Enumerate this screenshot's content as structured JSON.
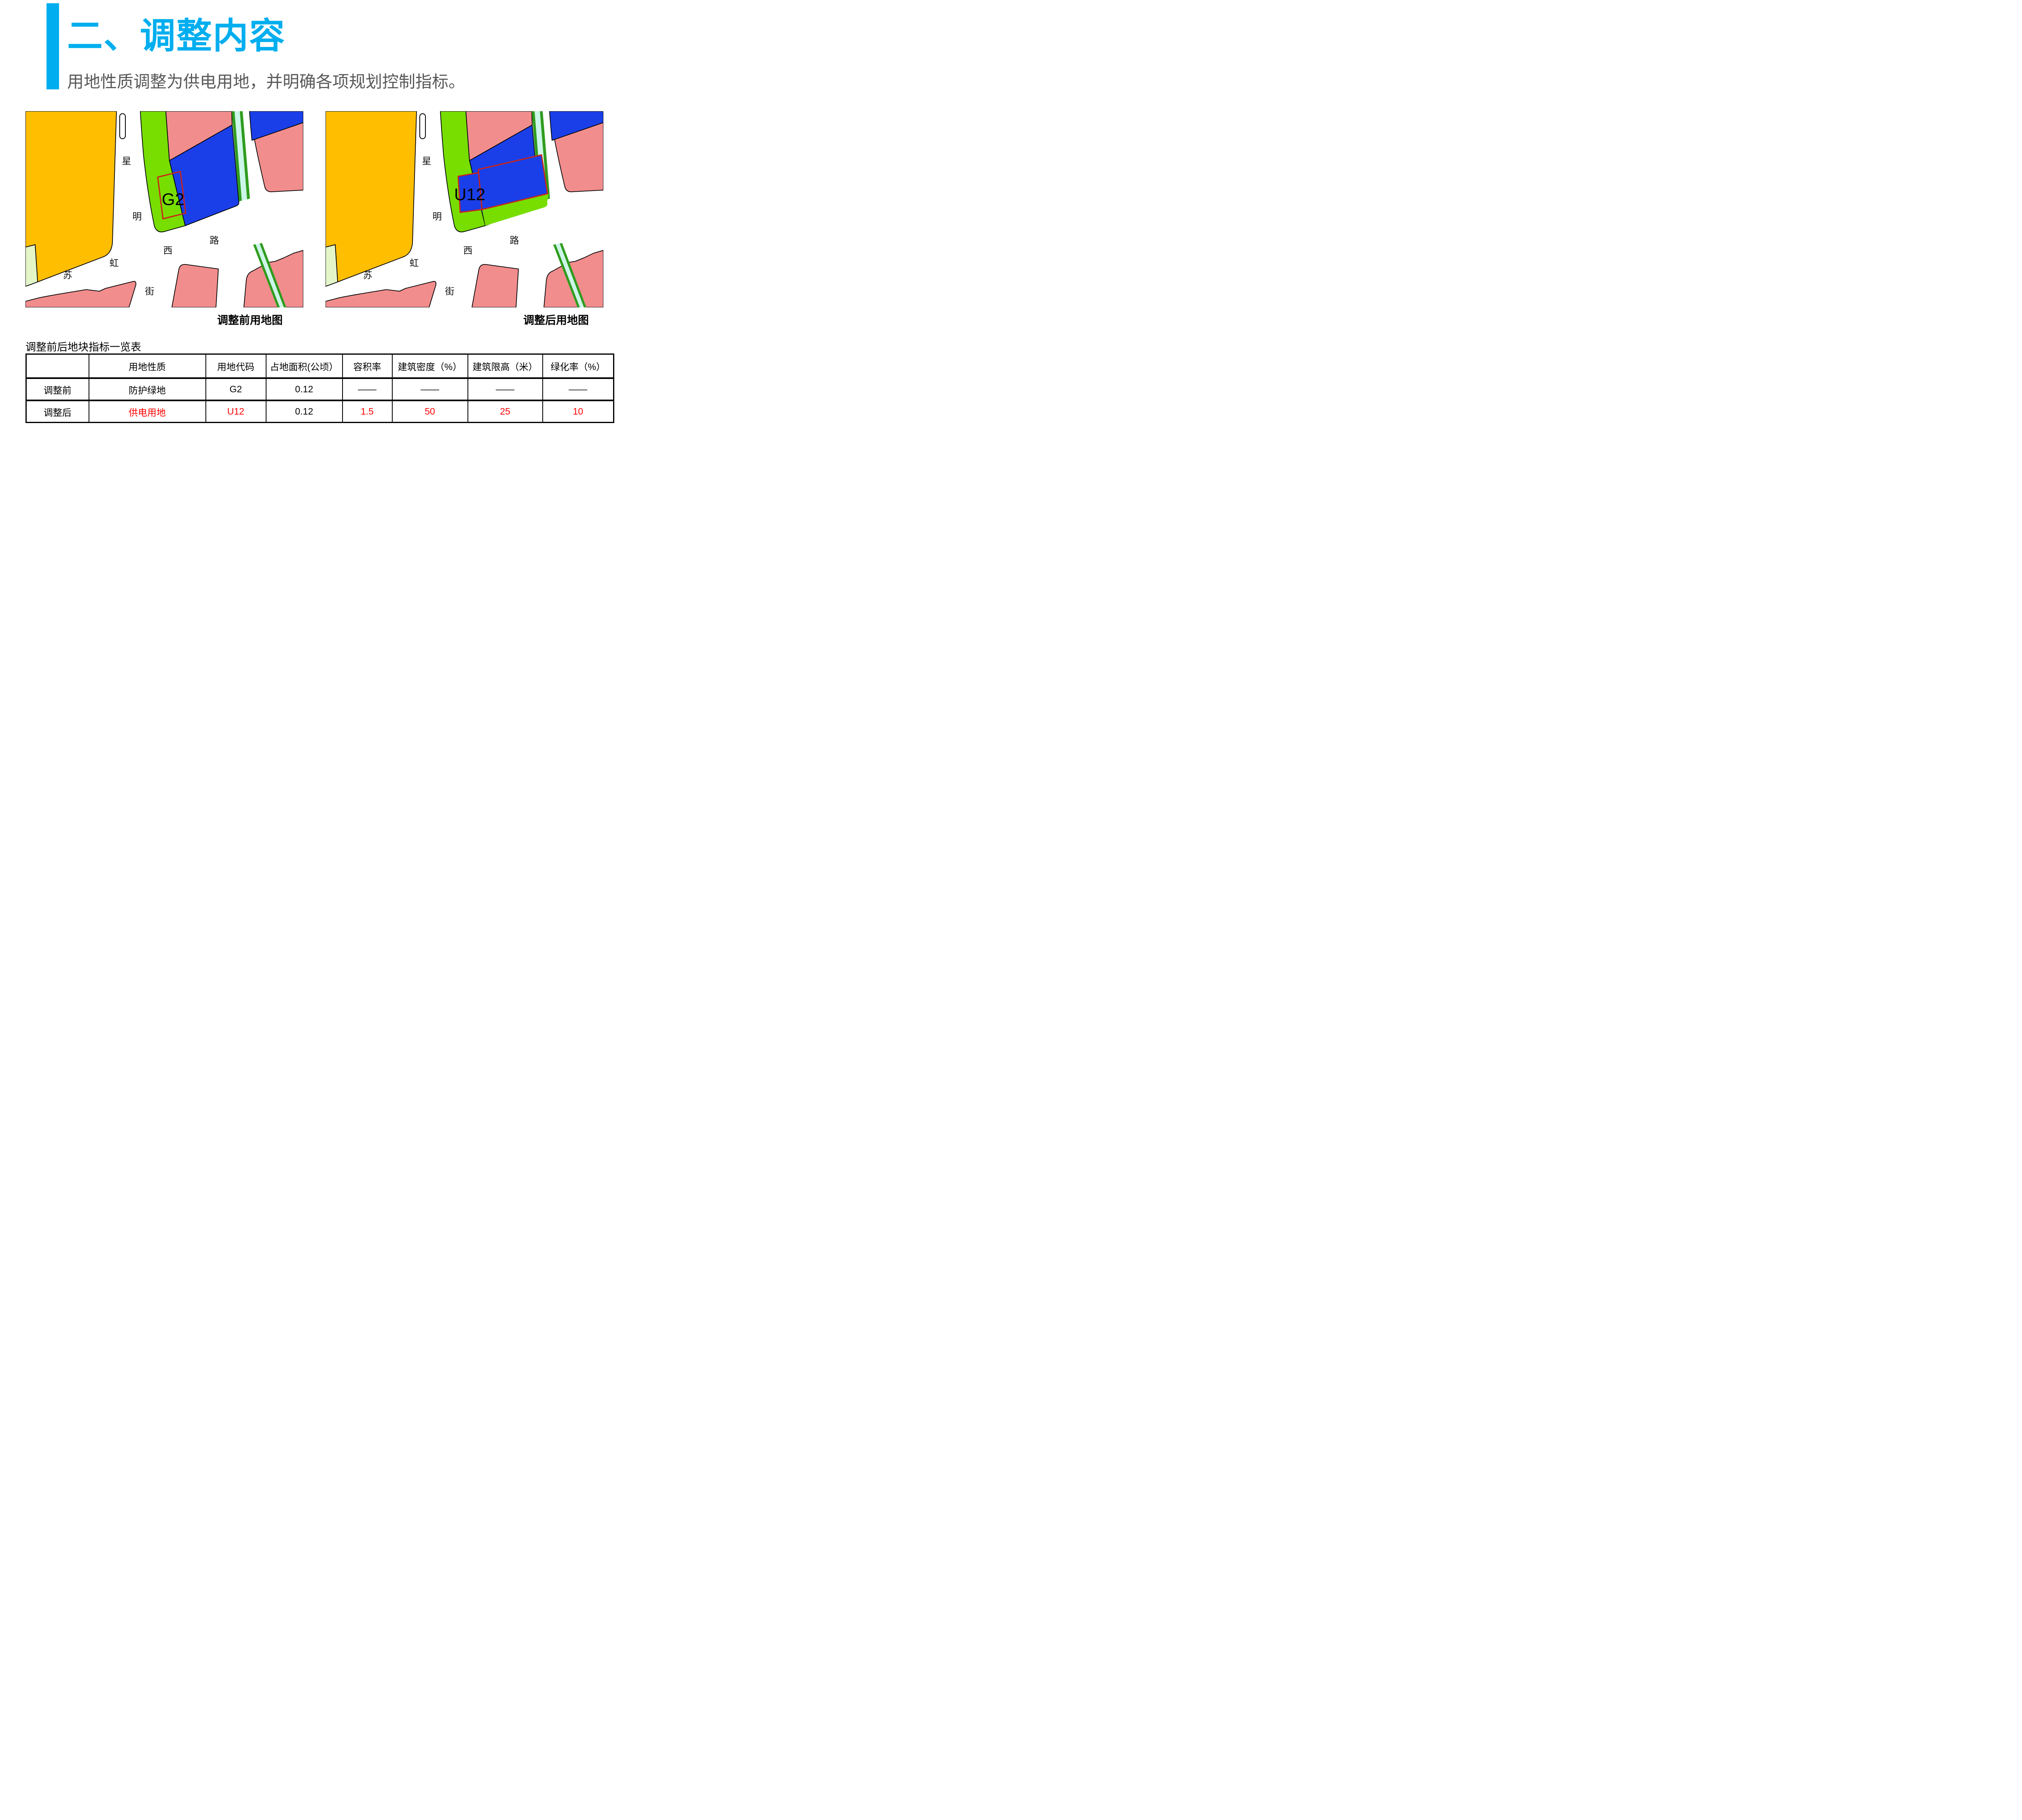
{
  "slide": {
    "title": "二、调整内容",
    "subtitle": "用地性质调整为供电用地，并明确各项规划控制指标。",
    "accent_color": "#00AEEF"
  },
  "maps": {
    "before": {
      "caption": "调整前用地图",
      "plot_label": "G2"
    },
    "after": {
      "caption": "调整后用地图",
      "plot_label": "U12"
    },
    "street_labels": {
      "xing": "星",
      "ming": "明",
      "jie": "街",
      "su": "苏",
      "hong": "虹",
      "xi": "西",
      "lu": "路"
    },
    "legend_colors": {
      "protective_green": "#77DE00",
      "pale_green": "#E4F6C8",
      "utility_blue": "#1A3FE8",
      "residential_pink": "#F28D8D",
      "orange_parcel": "#FFBE00",
      "canal_cyan": "#CCF6E8",
      "canal_green": "#2F9C1E",
      "plot_outline_red": "#CC2418",
      "highlight_red": "#FF0000"
    }
  },
  "table": {
    "title": "调整前后地块指标一览表",
    "headers": [
      "",
      "用地性质",
      "用地代码",
      "占地面积(公顷）",
      "容积率",
      "建筑密度（%）",
      "建筑限高（米）",
      "绿化率（%）"
    ],
    "rows": [
      {
        "label": "调整前",
        "land_use": "防护绿地",
        "code": "G2",
        "area": "0.12",
        "far": "——",
        "density": "——",
        "height": "——",
        "green_rate": "——"
      },
      {
        "label": "调整后",
        "land_use": "供电用地",
        "code": "U12",
        "area": "0.12",
        "far": "1.5",
        "density": "50",
        "height": "25",
        "green_rate": "10"
      }
    ]
  }
}
